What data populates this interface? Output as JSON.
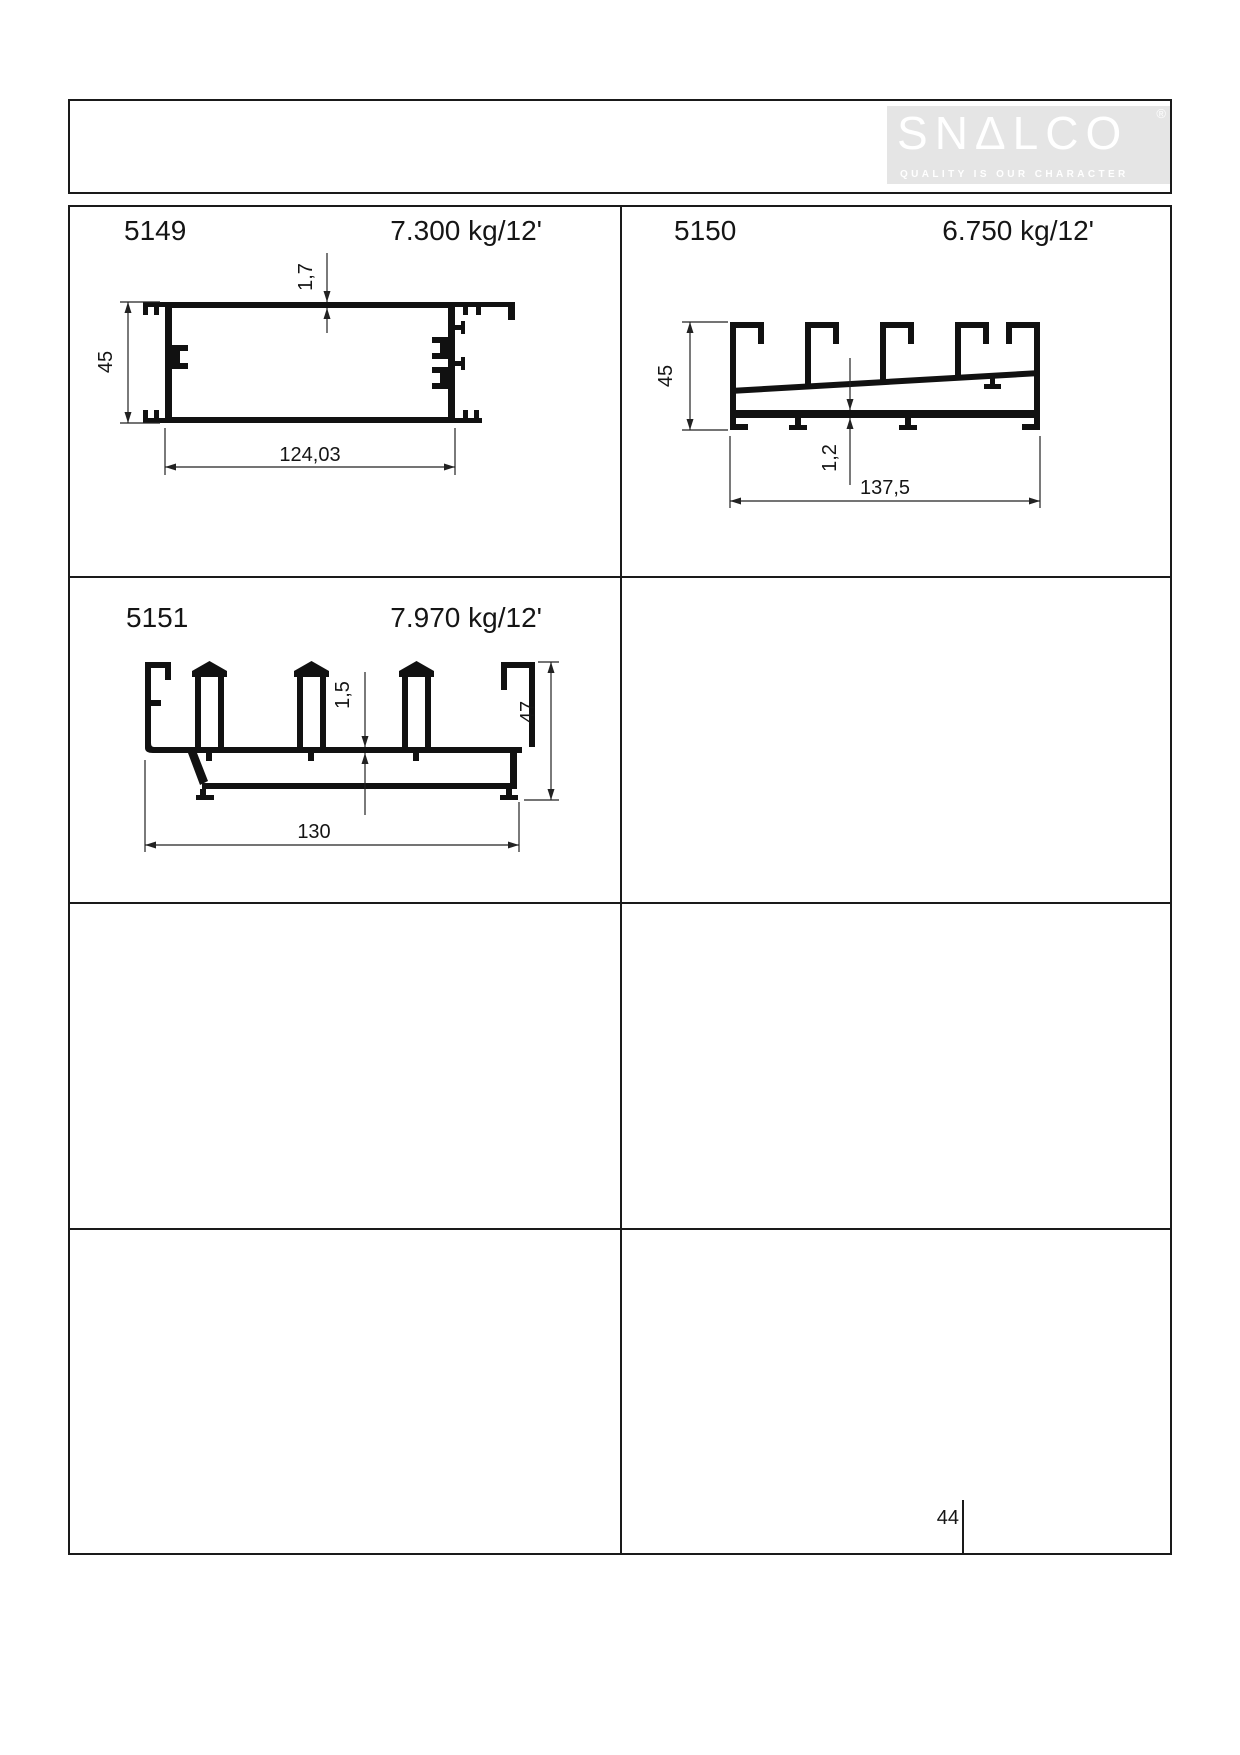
{
  "header": {
    "logo": {
      "text": "SNALCO",
      "registered": "®",
      "tagline": "QUALITY IS OUR CHARACTER"
    }
  },
  "catalog": {
    "profiles": [
      {
        "code": "5149",
        "weight": "7.300 kg/12'",
        "dims": {
          "height": "45",
          "thickness": "1,7",
          "width": "124,03"
        }
      },
      {
        "code": "5150",
        "weight": "6.750 kg/12'",
        "dims": {
          "height": "45",
          "thickness": "1,2",
          "width": "137,5"
        }
      },
      {
        "code": "5151",
        "weight": "7.970 kg/12'",
        "dims": {
          "height": "47",
          "thickness": "1,5",
          "width": "130"
        }
      }
    ],
    "page_number": "44"
  },
  "colors": {
    "logo_bg": "#e5e5e5",
    "logo_fg": "#ffffff",
    "line": "#111111"
  }
}
